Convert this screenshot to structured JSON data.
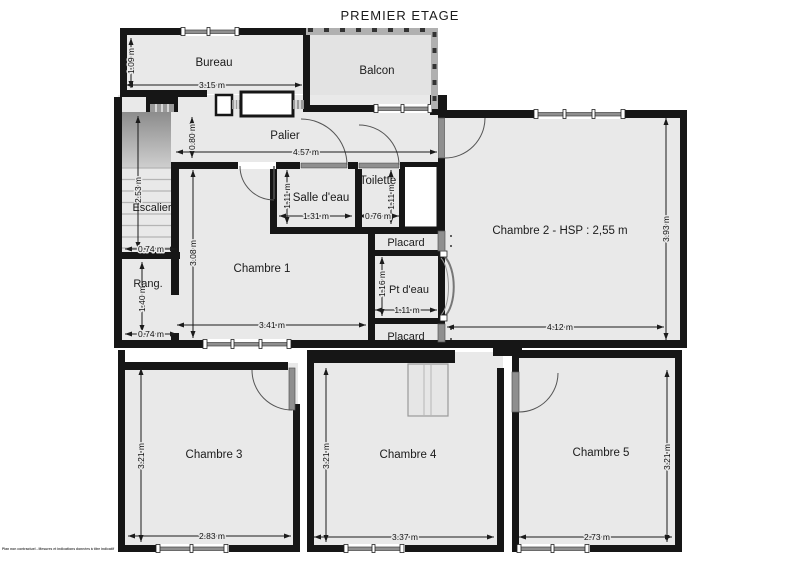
{
  "title": "PREMIER ETAGE",
  "disclaimer": "Plan non contractuel - Mesures et indications données à titre indicatif",
  "colors": {
    "wall": "#161616",
    "room_fill": "#e9e9e9",
    "window_glass": "#8f8f8f",
    "balcony_railing": "#b0b0b0",
    "dimension": "#1b1b1b",
    "background": "#ffffff"
  },
  "rooms": [
    {
      "id": "bureau",
      "label": "Bureau",
      "label_x": 214,
      "label_y": 63,
      "font_size": 11.5
    },
    {
      "id": "balcon",
      "label": "Balcon",
      "label_x": 377,
      "label_y": 71,
      "font_size": 11.5
    },
    {
      "id": "palier",
      "label": "Palier",
      "label_x": 285,
      "label_y": 136,
      "font_size": 11.5
    },
    {
      "id": "escalier",
      "label": "Escalier",
      "label_x": 152,
      "label_y": 208,
      "font_size": 11
    },
    {
      "id": "rangement",
      "label": "Rang.",
      "label_x": 148,
      "label_y": 284,
      "font_size": 11
    },
    {
      "id": "salle-deau",
      "label": "Salle d'eau",
      "label_x": 321,
      "label_y": 198,
      "font_size": 11.5
    },
    {
      "id": "toilette",
      "label": "Toilette",
      "label_x": 378,
      "label_y": 181,
      "font_size": 11.5
    },
    {
      "id": "chambre-1",
      "label": "Chambre 1",
      "label_x": 262,
      "label_y": 269,
      "font_size": 11.5
    },
    {
      "id": "chambre-2",
      "label": "Chambre 2 - HSP : 2,55 m",
      "label_x": 560,
      "label_y": 231,
      "font_size": 11.5
    },
    {
      "id": "placard-haut",
      "label": "Placard",
      "label_x": 406,
      "label_y": 243,
      "font_size": 11
    },
    {
      "id": "pt-deau",
      "label": "Pt d'eau",
      "label_x": 409,
      "label_y": 290,
      "font_size": 11
    },
    {
      "id": "placard-bas",
      "label": "Placard",
      "label_x": 406,
      "label_y": 337,
      "font_size": 11
    },
    {
      "id": "chambre-3",
      "label": "Chambre 3",
      "label_x": 214,
      "label_y": 455,
      "font_size": 11.5
    },
    {
      "id": "chambre-4",
      "label": "Chambre 4",
      "label_x": 408,
      "label_y": 455,
      "font_size": 11.5
    },
    {
      "id": "chambre-5",
      "label": "Chambre 5",
      "label_x": 601,
      "label_y": 453,
      "font_size": 11.5
    }
  ],
  "dimensions": [
    {
      "label": "1.09 m",
      "x1": 131,
      "y1": 38,
      "x2": 131,
      "y2": 88,
      "tx": 131,
      "ty": 61,
      "rotate": true
    },
    {
      "label": "3.15 m",
      "x1": 126,
      "y1": 85,
      "x2": 302,
      "y2": 85,
      "tx": 212,
      "ty": 85,
      "rotate": false
    },
    {
      "label": "0.80 m",
      "x1": 192,
      "y1": 117,
      "x2": 192,
      "y2": 158,
      "tx": 192,
      "ty": 137,
      "rotate": true
    },
    {
      "label": "4.57 m",
      "x1": 176,
      "y1": 152,
      "x2": 437,
      "y2": 152,
      "tx": 306,
      "ty": 152,
      "rotate": false
    },
    {
      "label": "2.53 m",
      "x1": 138,
      "y1": 116,
      "x2": 138,
      "y2": 249,
      "tx": 138,
      "ty": 190,
      "rotate": true
    },
    {
      "label": "0.74 m",
      "x1": 125,
      "y1": 249,
      "x2": 177,
      "y2": 249,
      "tx": 151,
      "ty": 249,
      "rotate": false
    },
    {
      "label": "3.08 m",
      "x1": 193,
      "y1": 170,
      "x2": 193,
      "y2": 338,
      "tx": 193,
      "ty": 253,
      "rotate": true
    },
    {
      "label": "1.11 m",
      "x1": 287,
      "y1": 170,
      "x2": 287,
      "y2": 224,
      "tx": 287,
      "ty": 196,
      "rotate": true
    },
    {
      "label": "1.31 m",
      "x1": 279,
      "y1": 216,
      "x2": 352,
      "y2": 216,
      "tx": 316,
      "ty": 216,
      "rotate": false
    },
    {
      "label": "1.11 m",
      "x1": 391,
      "y1": 170,
      "x2": 391,
      "y2": 224,
      "tx": 391,
      "ty": 197,
      "rotate": true
    },
    {
      "label": "0.76 m",
      "x1": 359,
      "y1": 216,
      "x2": 399,
      "y2": 216,
      "tx": 378,
      "ty": 216,
      "rotate": false
    },
    {
      "label": "1.16 m",
      "x1": 382,
      "y1": 257,
      "x2": 382,
      "y2": 316,
      "tx": 382,
      "ty": 284,
      "rotate": true
    },
    {
      "label": "1.11 m",
      "x1": 375,
      "y1": 310,
      "x2": 437,
      "y2": 310,
      "tx": 407,
      "ty": 310,
      "rotate": false
    },
    {
      "label": "1.40 m",
      "x1": 142,
      "y1": 262,
      "x2": 142,
      "y2": 332,
      "tx": 142,
      "ty": 299,
      "rotate": true
    },
    {
      "label": "0.74 m",
      "x1": 125,
      "y1": 334,
      "x2": 177,
      "y2": 334,
      "tx": 151,
      "ty": 334,
      "rotate": false
    },
    {
      "label": "3.41 m",
      "x1": 177,
      "y1": 325,
      "x2": 366,
      "y2": 325,
      "tx": 272,
      "ty": 325,
      "rotate": false
    },
    {
      "label": "3.93 m",
      "x1": 666,
      "y1": 118,
      "x2": 666,
      "y2": 340,
      "tx": 666,
      "ty": 229,
      "rotate": true
    },
    {
      "label": "4.12 m",
      "x1": 447,
      "y1": 327,
      "x2": 664,
      "y2": 327,
      "tx": 560,
      "ty": 327,
      "rotate": false
    },
    {
      "label": "3.21 m",
      "x1": 141,
      "y1": 368,
      "x2": 141,
      "y2": 542,
      "tx": 141,
      "ty": 456,
      "rotate": true
    },
    {
      "label": "2.83 m",
      "x1": 128,
      "y1": 536,
      "x2": 291,
      "y2": 536,
      "tx": 212,
      "ty": 536,
      "rotate": false
    },
    {
      "label": "3.21 m",
      "x1": 326,
      "y1": 368,
      "x2": 326,
      "y2": 542,
      "tx": 326,
      "ty": 456,
      "rotate": true
    },
    {
      "label": "3.37 m",
      "x1": 314,
      "y1": 537,
      "x2": 494,
      "y2": 537,
      "tx": 405,
      "ty": 537,
      "rotate": false
    },
    {
      "label": "3.21 m",
      "x1": 667,
      "y1": 370,
      "x2": 667,
      "y2": 542,
      "tx": 667,
      "ty": 457,
      "rotate": true
    },
    {
      "label": "2.73 m",
      "x1": 519,
      "y1": 537,
      "x2": 672,
      "y2": 537,
      "tx": 597,
      "ty": 537,
      "rotate": false
    }
  ]
}
